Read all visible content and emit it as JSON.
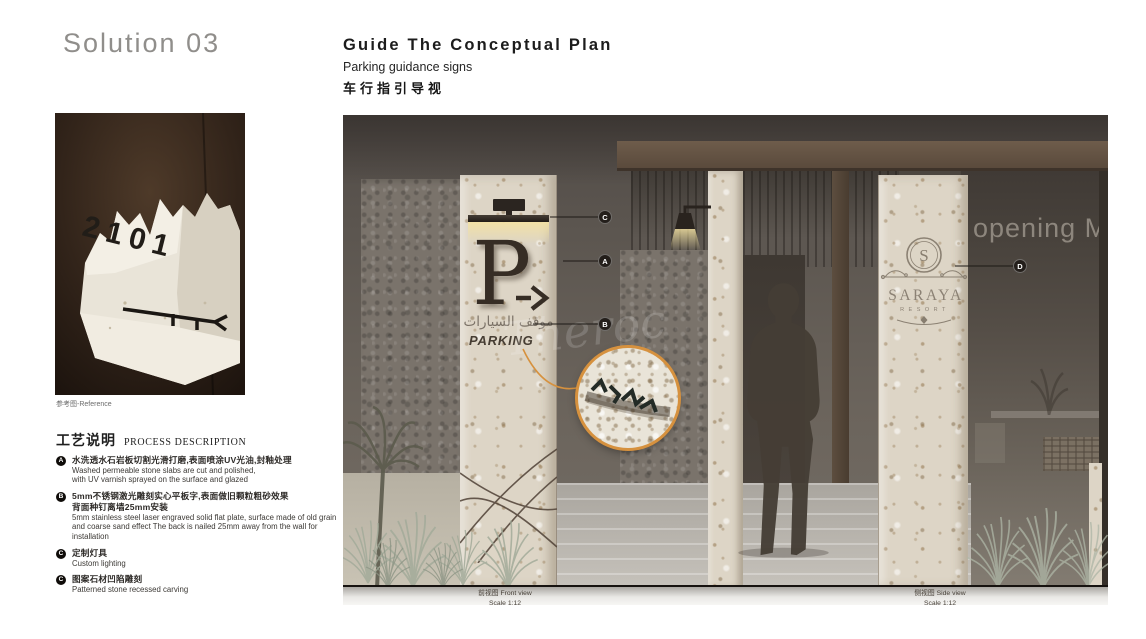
{
  "page": {
    "title": "Solution 03"
  },
  "header": {
    "title": "Guide The Conceptual Plan",
    "subtitle_en": "Parking guidance signs",
    "subtitle_zh": "车行指引导视"
  },
  "reference": {
    "caption": "参考图-Reference",
    "stone_number": "2101"
  },
  "process": {
    "heading_zh": "工艺说明",
    "heading_en": "PROCESS DESCRIPTION",
    "items": [
      {
        "badge": "A",
        "zh": [
          "水洗透水石岩板切割光滑打磨,表面喷涂UV光油,封釉处理"
        ],
        "en": [
          "Washed permeable stone slabs are cut and polished,",
          "with UV varnish sprayed on the surface and glazed"
        ]
      },
      {
        "badge": "B",
        "zh": [
          "5mm不锈钢激光雕刻实心平板字,表面做旧颗粒粗砂效果",
          "背面种钉离墙25mm安装"
        ],
        "en": [
          "5mm stainless steel laser engraved solid flat plate, surface made of old grain",
          "and coarse sand effect The back is nailed 25mm away from the wall for installation"
        ]
      },
      {
        "badge": "C",
        "zh": [
          "定制灯具"
        ],
        "en": [
          "Custom lighting"
        ]
      },
      {
        "badge": "C",
        "zh": [
          "图案石材凹陷雕刻"
        ],
        "en": [
          "Patterned stone recessed carving"
        ]
      }
    ]
  },
  "rendering": {
    "sign_front": {
      "letter": "P",
      "arrow": "→",
      "arabic": "موقف السيارات",
      "label": "PARKING"
    },
    "logo": {
      "initial": "S",
      "name": "SARAYA",
      "subtitle": "RESORT"
    },
    "background_text": "opening Ma",
    "watermark": "Theroc",
    "markers": {
      "a": "A",
      "b": "B",
      "c": "C",
      "d": "D"
    },
    "captions": {
      "front": {
        "zh": "前视图",
        "en": "Front view",
        "scale": "Scale 1:12"
      },
      "side": {
        "zh": "侧视图",
        "en": "Side view",
        "scale": "Scale 1:12"
      }
    }
  },
  "colors": {
    "accent_orange": "#d6913e",
    "travertine": "#ddd5c6",
    "badge_dark": "#0f0c09"
  }
}
